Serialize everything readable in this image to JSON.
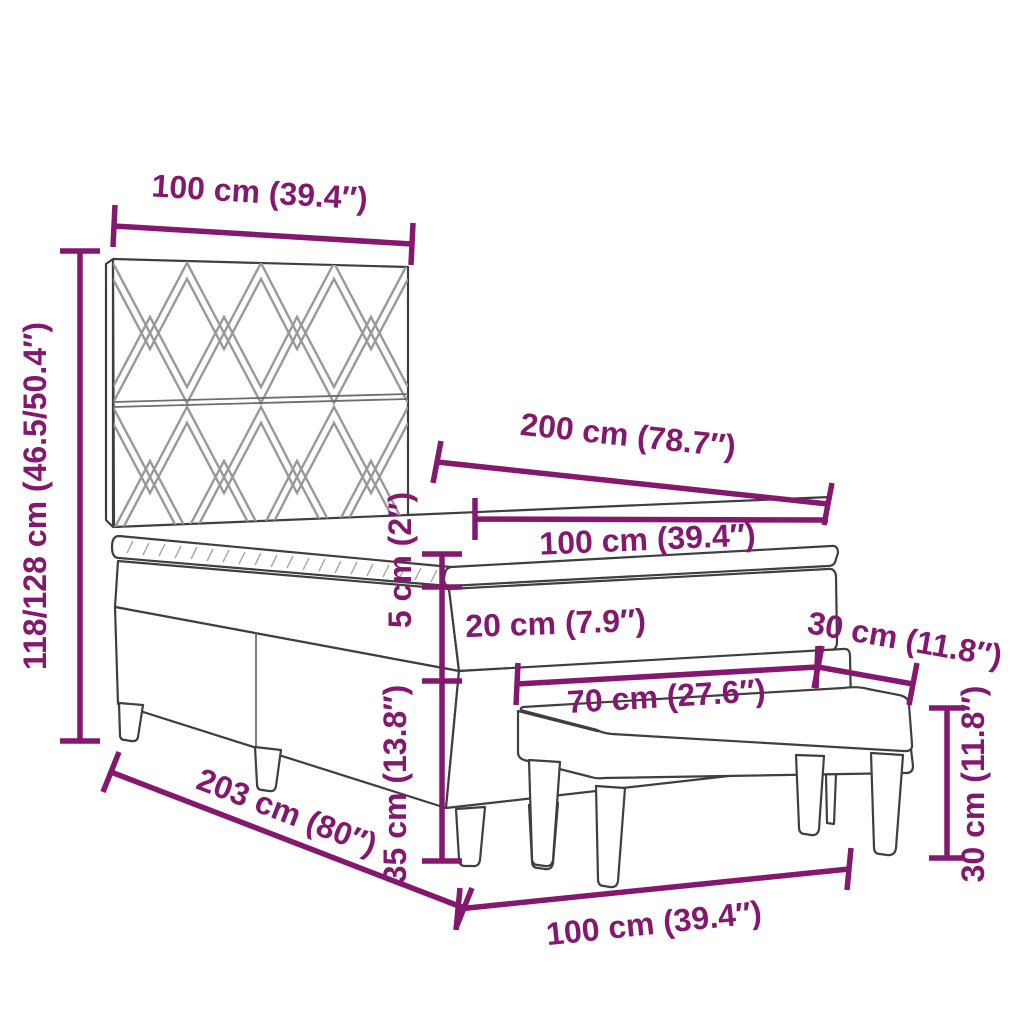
{
  "diagram": {
    "type": "product-dimension-diagram",
    "subject": "box spring bed with patterned headboard, mattress topper and bench",
    "colors": {
      "dimension": "#84186E",
      "outline": "#3F3F3F",
      "pattern": "#999999",
      "background": "#FFFFFF"
    },
    "dimensions": {
      "headboard_width": "100 cm (39.4″)",
      "headboard_height": "118/128 cm (46.5/50.4″)",
      "bed_length": "200 cm (78.7″)",
      "mattress_width": "100 cm (39.4″)",
      "topper_thickness": "5 cm (2″)",
      "mattress_thickness": "20 cm (7.9″)",
      "bench_depth": "30 cm (11.8″)",
      "bench_length": "70 cm (27.6″)",
      "base_height": "35 cm (13.8″)",
      "bed_total_length": "203 cm (80″)",
      "bench_height": "30 cm (11.8″)",
      "bed_foot_width": "100 cm (39.4″)"
    }
  }
}
